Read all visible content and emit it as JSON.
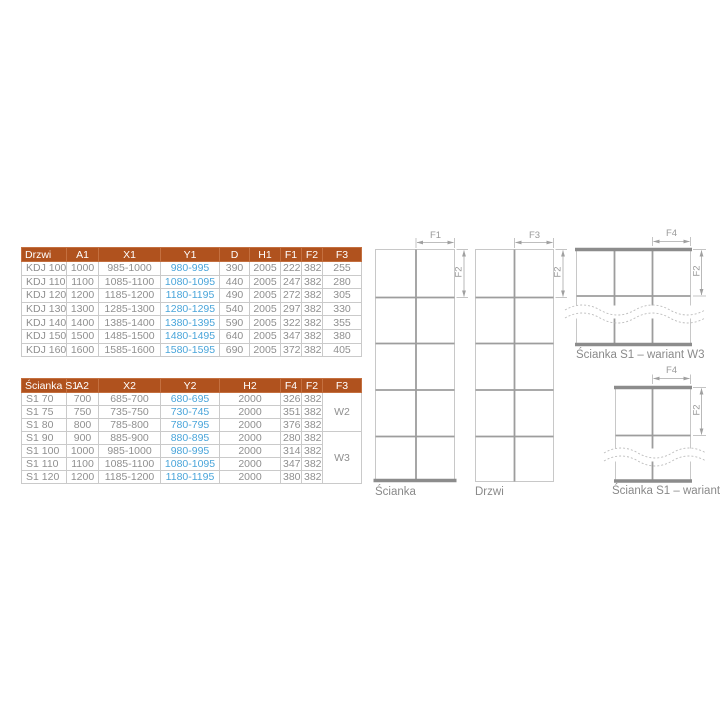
{
  "colors": {
    "header_bg": "#b0521e",
    "accent_blue": "#4aa5da",
    "body_text": "#8f8f8f",
    "cell_border": "#cacaca",
    "diagram_line": "#9d9d9d",
    "diagram_bar": "#8c8c8c"
  },
  "drzwi_table": {
    "name_col": 0,
    "blue_col": 3,
    "headers": [
      "Drzwi",
      "A1",
      "X1",
      "Y1",
      "D",
      "H1",
      "F1",
      "F2",
      "F3"
    ],
    "rows": [
      [
        "KDJ 100",
        "1000",
        "985-1000",
        "980-995",
        "390",
        "2005",
        "222",
        "382",
        "255"
      ],
      [
        "KDJ 110",
        "1100",
        "1085-1100",
        "1080-1095",
        "440",
        "2005",
        "247",
        "382",
        "280"
      ],
      [
        "KDJ 120",
        "1200",
        "1185-1200",
        "1180-1195",
        "490",
        "2005",
        "272",
        "382",
        "305"
      ],
      [
        "KDJ 130",
        "1300",
        "1285-1300",
        "1280-1295",
        "540",
        "2005",
        "297",
        "382",
        "330"
      ],
      [
        "KDJ 140",
        "1400",
        "1385-1400",
        "1380-1395",
        "590",
        "2005",
        "322",
        "382",
        "355"
      ],
      [
        "KDJ 150",
        "1500",
        "1485-1500",
        "1480-1495",
        "640",
        "2005",
        "347",
        "382",
        "380"
      ],
      [
        "KDJ 160",
        "1600",
        "1585-1600",
        "1580-1595",
        "690",
        "2005",
        "372",
        "382",
        "405"
      ]
    ]
  },
  "scianka_table": {
    "name_col": 0,
    "blue_col": 3,
    "colspans": {
      "4": 2
    },
    "headers": [
      "Ścianka S1",
      "A2",
      "X2",
      "Y2",
      "H2",
      "F4",
      "F2",
      "F3"
    ],
    "rows": [
      [
        "S1 70",
        "700",
        "685-700",
        "680-695",
        "2000",
        "326",
        "382"
      ],
      [
        "S1 75",
        "750",
        "735-750",
        "730-745",
        "2000",
        "351",
        "382"
      ],
      [
        "S1 80",
        "800",
        "785-800",
        "780-795",
        "2000",
        "376",
        "382"
      ],
      [
        "S1 90",
        "900",
        "885-900",
        "880-895",
        "2000",
        "280",
        "382"
      ],
      [
        "S1 100",
        "1000",
        "985-1000",
        "980-995",
        "2000",
        "314",
        "382"
      ],
      [
        "S1 110",
        "1100",
        "1085-1100",
        "1080-1095",
        "2000",
        "347",
        "382"
      ],
      [
        "S1 120",
        "1200",
        "1185-1200",
        "1180-1195",
        "2000",
        "380",
        "382"
      ]
    ],
    "groups": [
      {
        "label": "W2",
        "span": 3
      },
      {
        "label": "W3",
        "span": 4
      }
    ]
  },
  "diagrams": {
    "scianka": {
      "caption": "Ścianka",
      "dim_top": "F1",
      "dim_side": "F2"
    },
    "drzwi": {
      "caption": "Drzwi",
      "dim_top": "F3",
      "dim_side": "F2"
    },
    "w3": {
      "caption": "Ścianka S1 – wariant W3",
      "dim_top": "F4",
      "dim_side": "F2"
    },
    "w2": {
      "caption": "Ścianka S1 – wariant W2",
      "dim_top": "F4",
      "dim_side": "F2"
    }
  }
}
